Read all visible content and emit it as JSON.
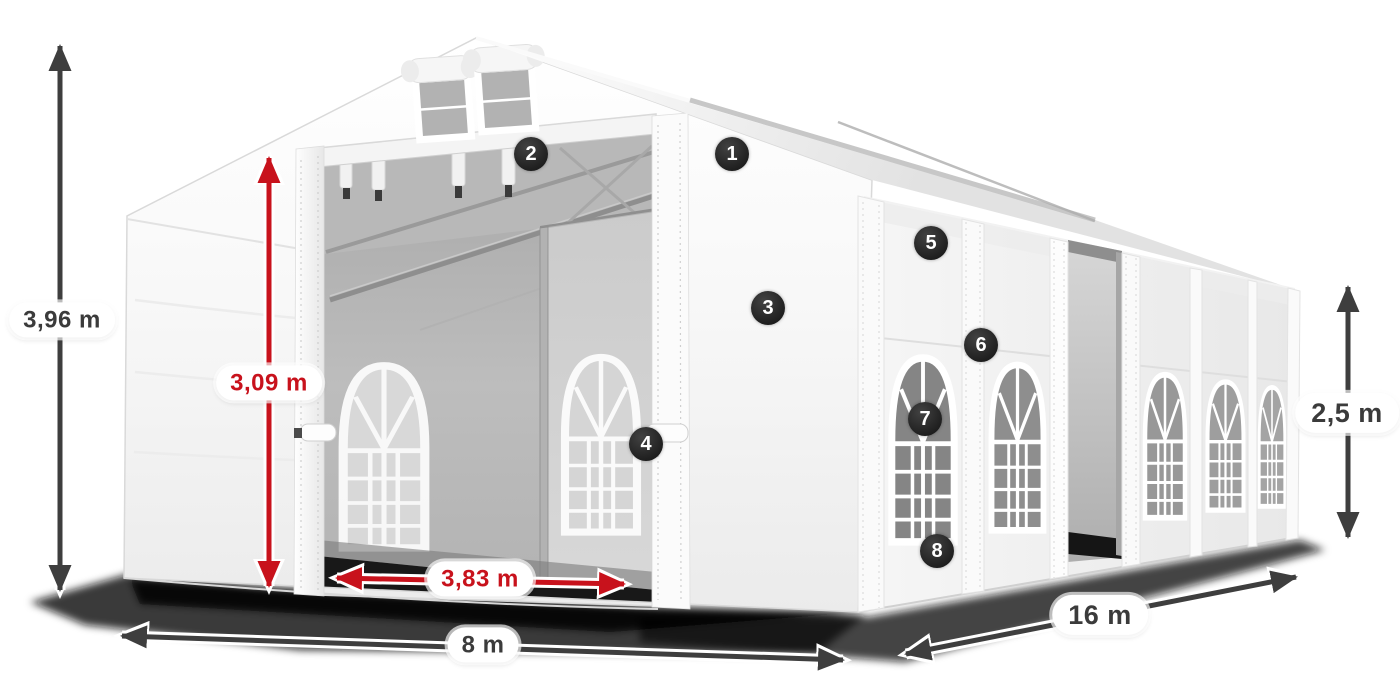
{
  "colors": {
    "background": "#ffffff",
    "dimension_dark": "#3e3e3e",
    "dimension_red": "#c8121c",
    "marker_background": "#262626",
    "marker_text": "#ffffff",
    "label_background": "#ffffff"
  },
  "dimensions": [
    {
      "id": "total-height",
      "label": "3,96 m",
      "style": "dark",
      "orientation": "vertical"
    },
    {
      "id": "entrance-height",
      "label": "3,09 m",
      "style": "red",
      "orientation": "vertical"
    },
    {
      "id": "entrance-width",
      "label": "3,83 m",
      "style": "red",
      "orientation": "horizontal"
    },
    {
      "id": "tent-width",
      "label": "8 m",
      "style": "dark",
      "orientation": "horizontal"
    },
    {
      "id": "tent-length",
      "label": "16 m",
      "style": "dark",
      "orientation": "diagonal"
    },
    {
      "id": "side-height",
      "label": "2,5 m",
      "style": "dark",
      "orientation": "vertical"
    }
  ],
  "markers": [
    {
      "number": "1"
    },
    {
      "number": "2"
    },
    {
      "number": "3"
    },
    {
      "number": "4"
    },
    {
      "number": "5"
    },
    {
      "number": "6"
    },
    {
      "number": "7"
    },
    {
      "number": "8"
    }
  ]
}
